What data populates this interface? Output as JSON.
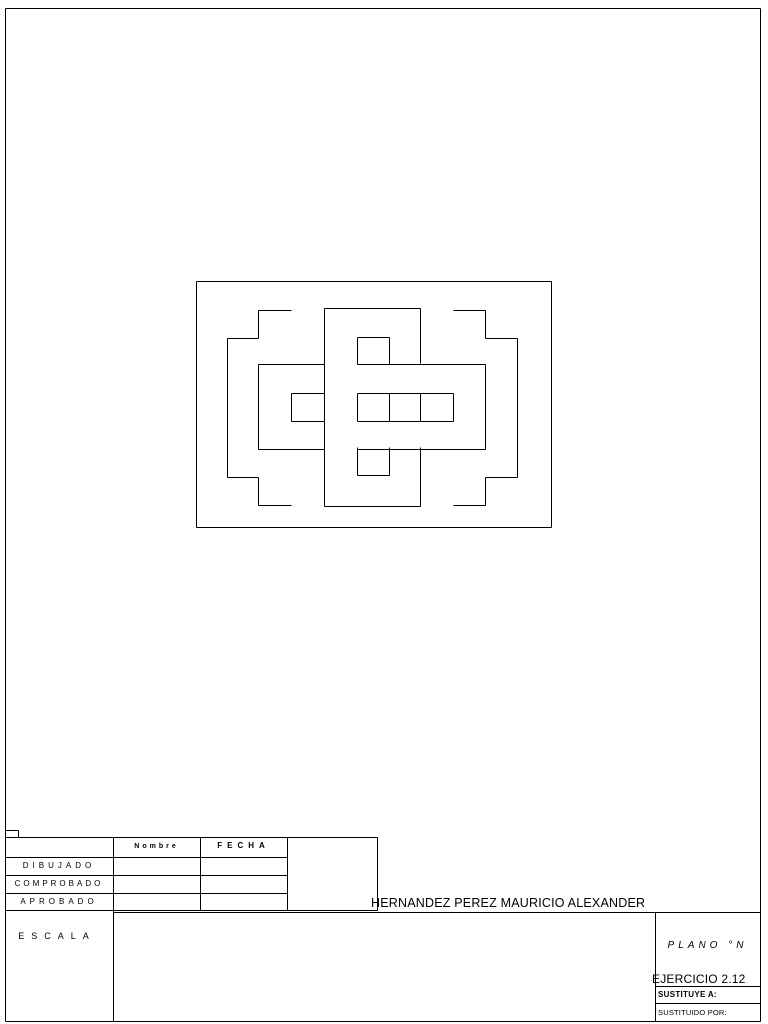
{
  "page": {
    "background": "#ffffff",
    "line_color": "#000000",
    "border_segments": [
      [
        5,
        8,
        760,
        8
      ],
      [
        5,
        8,
        5,
        1021
      ],
      [
        760,
        8,
        760,
        1021
      ]
    ]
  },
  "drawing": {
    "frame_segments": [
      [
        196,
        281,
        551,
        281
      ],
      [
        196,
        527,
        551,
        527
      ],
      [
        196,
        281,
        196,
        527
      ],
      [
        551,
        281,
        551,
        527
      ]
    ],
    "figure_segments": [
      [
        258,
        310,
        291,
        310
      ],
      [
        258,
        310,
        258,
        338
      ],
      [
        227,
        338,
        258,
        338
      ],
      [
        227,
        338,
        227,
        477
      ],
      [
        227,
        477,
        258,
        477
      ],
      [
        258,
        477,
        258,
        505
      ],
      [
        258,
        505,
        291,
        505
      ],
      [
        453,
        310,
        485,
        310
      ],
      [
        485,
        310,
        485,
        338
      ],
      [
        485,
        338,
        517,
        338
      ],
      [
        517,
        338,
        517,
        477
      ],
      [
        485,
        477,
        517,
        477
      ],
      [
        485,
        477,
        485,
        505
      ],
      [
        453,
        505,
        485,
        505
      ],
      [
        324,
        308,
        420,
        308
      ],
      [
        324,
        308,
        324,
        506
      ],
      [
        324,
        506,
        420,
        506
      ],
      [
        420,
        308,
        420,
        363
      ],
      [
        420,
        393,
        420,
        421
      ],
      [
        420,
        447,
        420,
        506
      ],
      [
        357,
        337,
        389,
        337
      ],
      [
        357,
        337,
        357,
        364
      ],
      [
        389,
        337,
        389,
        364
      ],
      [
        357,
        393,
        357,
        421
      ],
      [
        389,
        393,
        389,
        421
      ],
      [
        357,
        447,
        357,
        475
      ],
      [
        389,
        447,
        389,
        475
      ],
      [
        357,
        475,
        389,
        475
      ],
      [
        258,
        364,
        324,
        364
      ],
      [
        357,
        364,
        485,
        364
      ],
      [
        258,
        364,
        258,
        449
      ],
      [
        485,
        364,
        485,
        449
      ],
      [
        258,
        449,
        324,
        449
      ],
      [
        357,
        449,
        485,
        449
      ],
      [
        291,
        393,
        324,
        393
      ],
      [
        357,
        393,
        453,
        393
      ],
      [
        291,
        421,
        324,
        421
      ],
      [
        357,
        421,
        453,
        421
      ],
      [
        291,
        393,
        291,
        421
      ],
      [
        453,
        393,
        453,
        421
      ]
    ]
  },
  "titleblock": {
    "lines": [
      [
        5,
        830,
        18,
        830
      ],
      [
        18,
        830,
        18,
        837
      ],
      [
        5,
        837,
        377,
        837
      ],
      [
        5,
        857,
        287,
        857
      ],
      [
        5,
        875,
        287,
        875
      ],
      [
        5,
        893,
        287,
        893
      ],
      [
        5,
        910,
        377,
        910
      ],
      [
        113,
        912,
        760,
        912
      ],
      [
        655,
        986,
        760,
        986
      ],
      [
        655,
        1003,
        760,
        1003
      ],
      [
        5,
        1021,
        760,
        1021
      ],
      [
        113,
        837,
        113,
        1021
      ],
      [
        200,
        837,
        200,
        910
      ],
      [
        287,
        837,
        287,
        910
      ],
      [
        377,
        837,
        377,
        910
      ],
      [
        655,
        912,
        655,
        1021
      ]
    ],
    "header": {
      "nombre": "Nombre",
      "fecha": "FECHA"
    },
    "rows": [
      {
        "label": "DIBUJADO"
      },
      {
        "label": "COMPROBADO"
      },
      {
        "label": "APROBADO"
      }
    ],
    "escala_label": "ESCALA",
    "author_name": "HERNANDEZ PEREZ MAURICIO ALEXANDER",
    "plano_label": "PLANO °N",
    "exercise_label": "EJERCICIO 2.12",
    "sustituye_label": "SUSTITUYE A:",
    "sustituido_label": "SUSTITUIDO POR:"
  }
}
